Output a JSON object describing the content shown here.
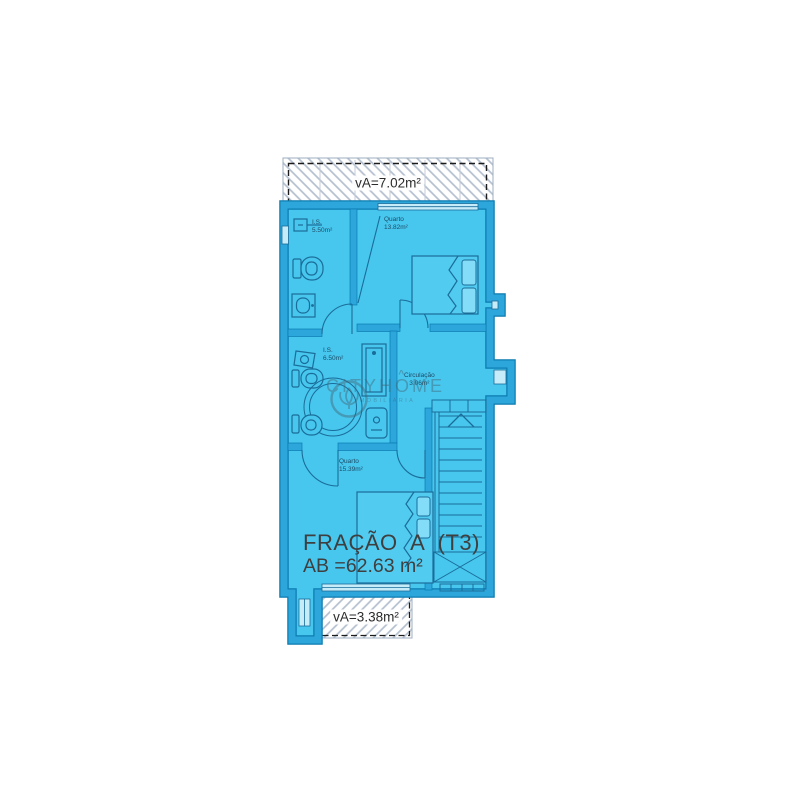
{
  "plan": {
    "title": "FRAÇÃO A (T3)",
    "gross_area": "AB =62.63 m²",
    "balconies": {
      "top": "vA=7.02m²",
      "bottom": "vA=3.38m²"
    },
    "rooms": [
      {
        "name": "I.S.",
        "area": "5.50m²"
      },
      {
        "name": "Quarto",
        "area": "13.82m²"
      },
      {
        "name": "I.S.",
        "area": "6.50m²"
      },
      {
        "name": "Circulação",
        "area": "3.06m²"
      },
      {
        "name": "Quarto",
        "area": "15.39m²"
      }
    ]
  },
  "watermark": {
    "brand_pre": "CITYH",
    "brand_o": "O",
    "brand_post": "ME",
    "subtitle": "IMOBILIÁRIA"
  },
  "colors": {
    "floor_fill": "#47C6EE",
    "wall_band": "#2CA6DB",
    "outer_edge": "#0C7CB0",
    "detail_line": "#1A6D99",
    "hatch_line": "#B3BFCF",
    "label_text": "#1E4C66",
    "title_text": "#3F3F3F"
  }
}
